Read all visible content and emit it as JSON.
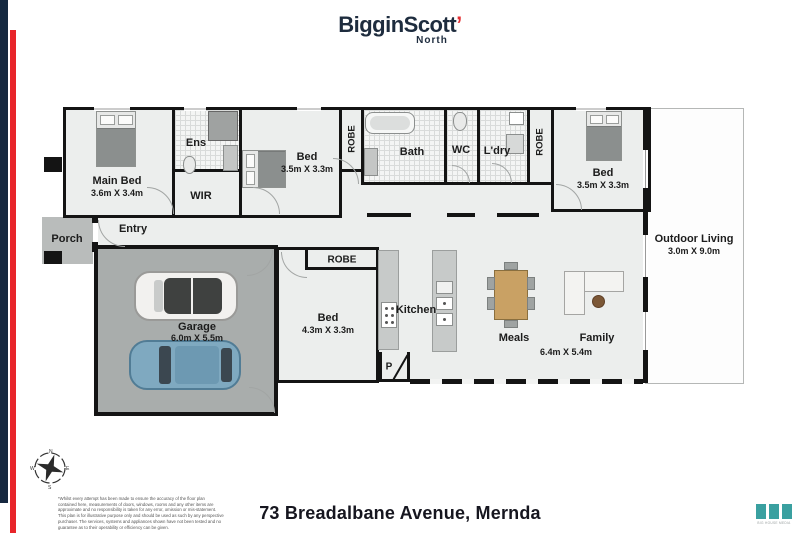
{
  "brand": {
    "name": "BigginScott",
    "tick": "’",
    "sub_label": "North",
    "navy": "#1e2c3e",
    "red": "#e42f33"
  },
  "plan": {
    "rooms": {
      "main_bed": {
        "label": "Main Bed",
        "dims": "3.6m X 3.4m"
      },
      "ens": {
        "label": "Ens"
      },
      "wir": {
        "label": "WIR"
      },
      "bed2": {
        "label": "Bed",
        "dims": "3.5m X 3.3m"
      },
      "robe2": {
        "label": "ROBE"
      },
      "bath": {
        "label": "Bath"
      },
      "wc": {
        "label": "WC"
      },
      "ldry": {
        "label": "L'dry"
      },
      "robe3": {
        "label": "ROBE"
      },
      "bed3": {
        "label": "Bed",
        "dims": "3.5m X 3.3m"
      },
      "outdoor_living": {
        "label": "Outdoor Living",
        "dims": "3.0m X 9.0m"
      },
      "porch": {
        "label": "Porch"
      },
      "entry": {
        "label": "Entry"
      },
      "garage": {
        "label": "Garage",
        "dims": "6.0m X 5.5m"
      },
      "robe4": {
        "label": "ROBE"
      },
      "bed4": {
        "label": "Bed",
        "dims": "4.3m X 3.3m"
      },
      "kitchen": {
        "label": "Kitchen"
      },
      "pantry": {
        "label": "P"
      },
      "meals": {
        "label": "Meals"
      },
      "family": {
        "label": "Family",
        "dims": "6.4m X 5.4m"
      }
    }
  },
  "compass": {
    "n": "N",
    "e": "E",
    "s": "S",
    "w": "W"
  },
  "footer": {
    "address": "73 Breadalbane Avenue, Mernda",
    "disclaimer_lines": [
      "*Whilst every attempt has been made to ensure the accuracy of the floor plan",
      "contained here, measurements of doors, windows, rooms and any other items are",
      "approximate and no responsibility is taken for any error, omission or mis-statement.",
      "This plan is for illustrative purpose only and should be used as such by any perspective",
      "purchaser. The services, systems and appliances shown have not been tested and no",
      "guarantee as to their operability or efficiency can be given."
    ],
    "media_logo_caption": "BIG HOUSE MEDIA"
  }
}
